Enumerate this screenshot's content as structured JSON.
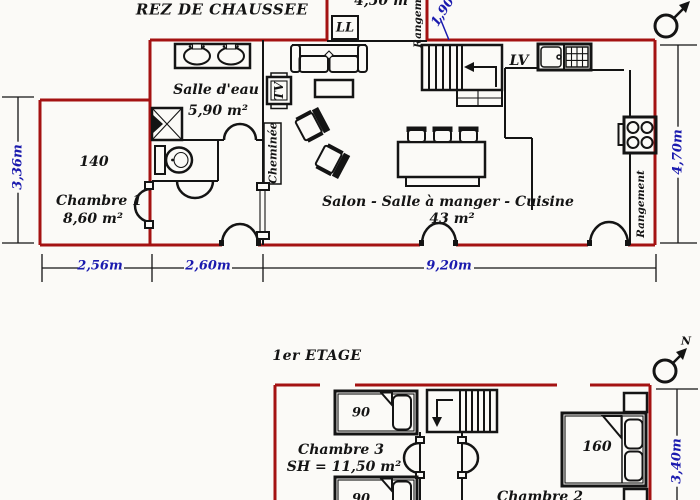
{
  "colors": {
    "bg": "#fbfaf7",
    "ink": "#141414",
    "wall": "#a41212",
    "blue": "#1a1aae"
  },
  "floor_plan": {
    "ground_floor": {
      "title": "REZ DE CHAUSSEE",
      "rooms": {
        "bathroom": {
          "name": "Salle d'eau",
          "area": "5,90 m²"
        },
        "bedroom1": {
          "name": "Chambre 1",
          "area": "8,60 m²",
          "bed_size": "140"
        },
        "living": {
          "name": "Salon - Salle à manger - Cuisine",
          "area": "43 m²"
        }
      },
      "labels": {
        "washer": "LL",
        "dishwasher": "LV",
        "tv": "TV",
        "fireplace": "Cheminée",
        "storage_top": "Rangement",
        "storage_right": "Rangement"
      },
      "dimensions": {
        "top_width": "4,50 m",
        "stair_width": "1,90",
        "left_height": "3,36m",
        "right_height": "4,70m",
        "bottom_segments": [
          "2,56m",
          "2,60m",
          "9,20m"
        ]
      }
    },
    "first_floor": {
      "title": "1er ETAGE",
      "rooms": {
        "bedroom3": {
          "name": "Chambre 3",
          "area_label": "SH = 11,50 m²",
          "bed_sizes": [
            "90",
            "90"
          ]
        },
        "bedroom2": {
          "name": "Chambre 2",
          "bed_size": "160"
        }
      },
      "dimensions": {
        "right_height": "3,40m"
      }
    },
    "compass": {
      "north": "N"
    }
  }
}
